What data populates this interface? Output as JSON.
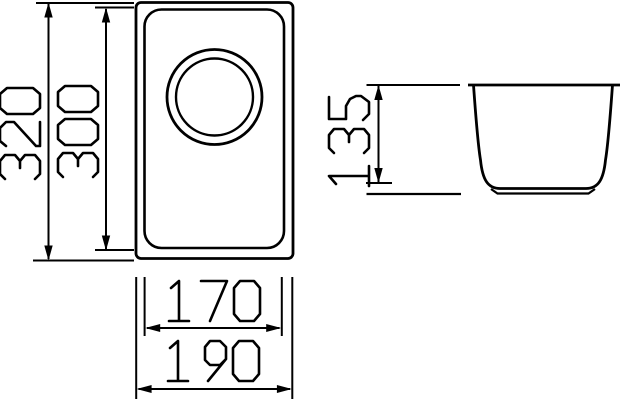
{
  "colors": {
    "line": "#000000",
    "background": "#ffffff"
  },
  "views": {
    "top_view": {
      "description": "sink top view with drain circle"
    },
    "side_view": {
      "description": "sink bowl cross-section view"
    }
  },
  "dimensions": {
    "overall_length": {
      "value": "320"
    },
    "bowl_length": {
      "value": "300"
    },
    "bowl_width": {
      "value": "170"
    },
    "overall_width": {
      "value": "190"
    },
    "bowl_depth": {
      "value": "135"
    }
  }
}
